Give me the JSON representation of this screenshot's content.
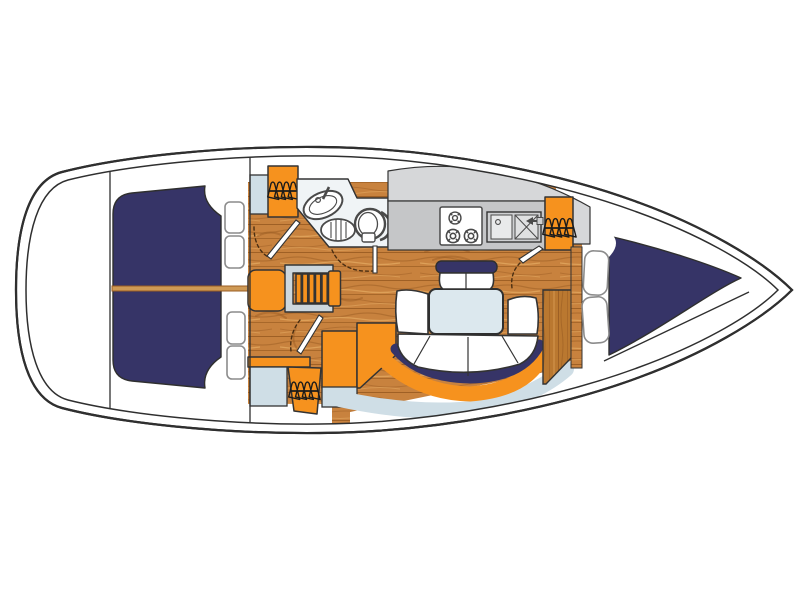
{
  "figure": {
    "type": "diagram",
    "subject": "sailboat-interior-layout-top-view"
  },
  "colors": {
    "white": "#ffffff",
    "hull_stroke": "#2f2f2f",
    "outline": "#333333",
    "navy": "#363467",
    "orange": "#F6921E",
    "tan": "#CF9A55",
    "wood": "#C8823E",
    "wood_dark": "#9A5C22",
    "wood_light": "#E2A75F",
    "wood_bulkhead": "#BA7830",
    "lightblue": "#CFDEE6",
    "gray_upper": "#D6D7D9",
    "gray_lower": "#C5C6C8",
    "stair_frame": "#CDD7DD",
    "fixture": "#4A4A4A",
    "door_arc": "#4a2e12",
    "pillow_stroke": "#8C8C8C",
    "icon_ink": "#1b1b1b"
  },
  "icons": {
    "hanger_rack": "clothes-hanger-rack-icon",
    "stove_burner": "stove-burner-icon",
    "faucet": "faucet-icon"
  },
  "parts": {
    "aft_double_berth": "aft cabin double berth",
    "v_berth": "bow V-berth",
    "head": "bathroom with sink, shower grate and toilet",
    "galley": "galley with stove and double sink",
    "dinette": "U-shaped settee with table",
    "companionway": "companionway steps",
    "hanging_lockers": "4 hanging lockers"
  }
}
